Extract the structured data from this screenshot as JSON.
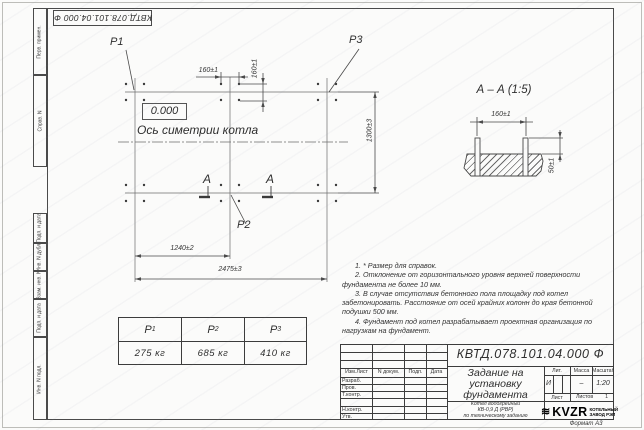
{
  "page": {
    "doc_number": "КВТД.078.101.04.000 Ф",
    "format_label": "Формат А3"
  },
  "left_margin": {
    "cells": [
      "Перв. примен.",
      "Справ. N",
      "Подп. и дата",
      "Инв. N дубл.",
      "Взам. инв. N",
      "Подп. и дата",
      "Инв. N подл."
    ]
  },
  "plan": {
    "p1": "P1",
    "p2": "P2",
    "p3": "P3",
    "level_mark": "0.000",
    "axis_label": "Ось симетрии котла",
    "section_letter": "А",
    "dim_160_h": "160±1",
    "dim_160_v": "160±1",
    "dim_1300": "1300±3",
    "dim_1240": "1240±2",
    "dim_2475": "2475±3"
  },
  "section_view": {
    "title": "А – А (1:5)",
    "dim_160": "160±1",
    "dim_50": "50±1"
  },
  "load_table": {
    "columns": [
      {
        "name": "P",
        "sub": "1",
        "value": "275 кг"
      },
      {
        "name": "P",
        "sub": "2",
        "value": "685 кг"
      },
      {
        "name": "P",
        "sub": "3",
        "value": "410 кг"
      }
    ]
  },
  "notes": [
    "1. * Размер для справок.",
    "2. Отклонение от горизонтального уровня верхней поверхности фундамента не более 10 мм.",
    "3. В случае отсутствия бетонного пола площадку под котел забетонировать. Расстояние от осей крайних колонн до края бетонной подушки 500 мм.",
    "4. Фундамент под котел разрабатывает проектная организация по нагрузкам на фундамент."
  ],
  "title_block": {
    "doc_number": "КВТД.078.101.04.000 Ф",
    "title_lines": [
      "Задание на",
      "установку",
      "фундамента"
    ],
    "subtitle_lines": [
      "Котел водогрейный",
      "КВ-0,9 Д (РВР)",
      "по техническому заданию"
    ],
    "col_headers": [
      "Изм.Лист",
      "N докум.",
      "Подп.",
      "Дата"
    ],
    "row_labels": [
      "Разраб.",
      "Пров.",
      "Т.контр.",
      "Н.контр.",
      "Утв."
    ],
    "lit_header": "Лит.",
    "mass_header": "Масса",
    "scale_header": "Масштаб",
    "lit_value": "И",
    "mass_value": "–",
    "scale_value": "1:20",
    "sheet_label": "Лист",
    "sheets_label": "Листов",
    "sheets_value": "1",
    "logo_text": "KVZR",
    "logo_caption_lines": [
      "КОТЕЛЬНЫЙ",
      "ЗАВОД РЭП"
    ]
  }
}
